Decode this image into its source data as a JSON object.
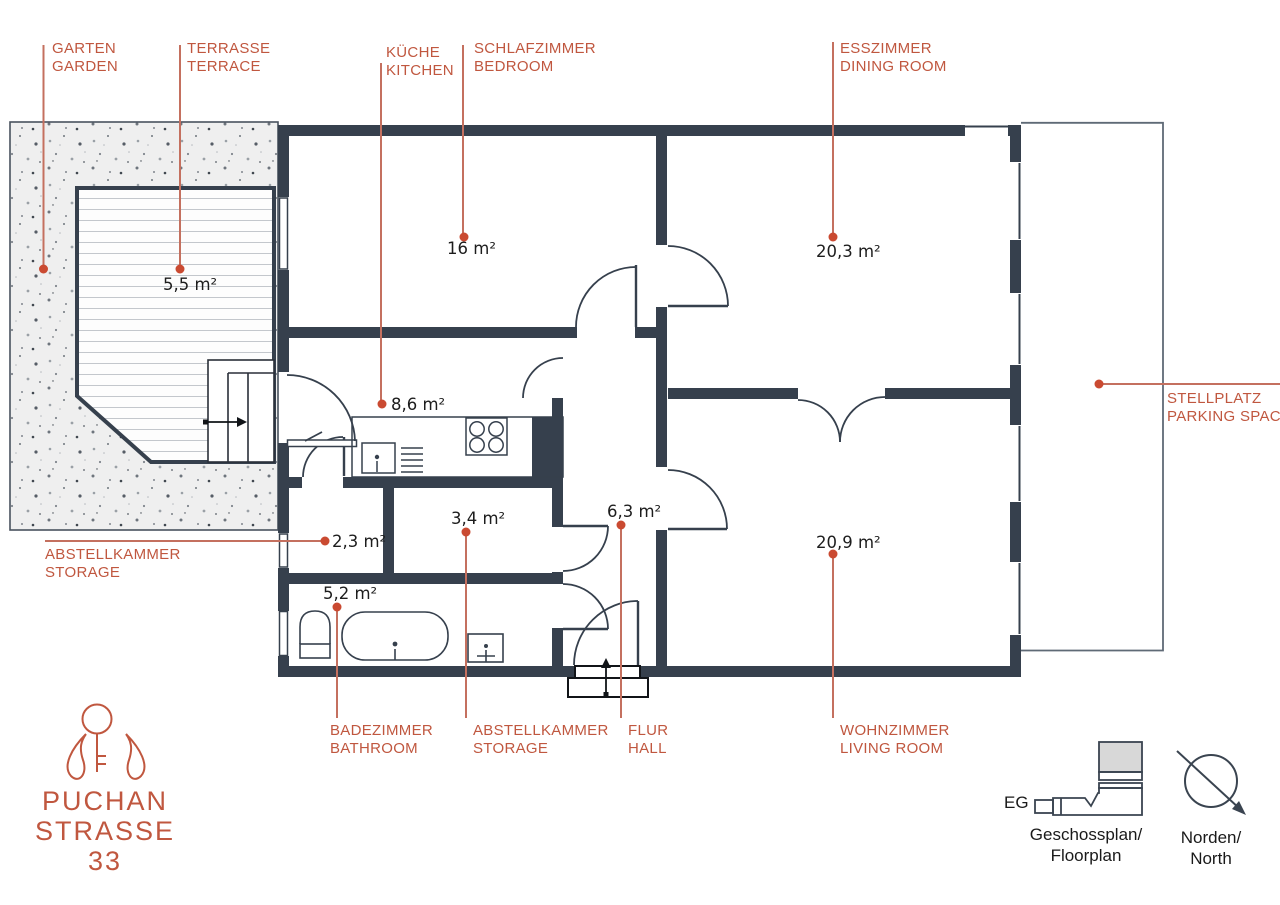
{
  "plan": {
    "callouts": {
      "garten": {
        "de": "GARTEN",
        "en": "GARDEN"
      },
      "terrasse": {
        "de": "TERRASSE",
        "en": "TERRACE"
      },
      "kueche": {
        "de": "KÜCHE",
        "en": "KITCHEN"
      },
      "schlafzimmer": {
        "de": "SCHLAFZIMMER",
        "en": "BEDROOM"
      },
      "esszimmer": {
        "de": "ESSZIMMER",
        "en": "DINING ROOM"
      },
      "stellplatz": {
        "de": "STELLPLATZ",
        "en": "PARKING SPACES"
      },
      "abstell_left": {
        "de": "ABSTELLKAMMER",
        "en": "STORAGE"
      },
      "badezimmer": {
        "de": "BADEZIMMER",
        "en": "BATHROOM"
      },
      "abstell_bottom": {
        "de": "ABSTELLKAMMER",
        "en": "STORAGE"
      },
      "flur": {
        "de": "FLUR",
        "en": "HALL"
      },
      "wohnzimmer": {
        "de": "WOHNZIMMER",
        "en": "LIVING ROOM"
      }
    },
    "areas": {
      "bedroom": "16 m²",
      "dining": "20,3 m²",
      "terrace": "5,5 m²",
      "kitchen": "8,6 m²",
      "storage_small": "2,3 m²",
      "storage_mid": "3,4 m²",
      "hall": "6,3 m²",
      "living": "20,9 m²",
      "bathroom": "5,2 m²"
    }
  },
  "logo": {
    "line1": "PUCHAN",
    "line2": "STRASSE",
    "line3": "33"
  },
  "legend": {
    "eg": "EG",
    "floorplan_de": "Geschossplan/",
    "floorplan_en": "Floorplan",
    "north_de": "Norden/",
    "north_en": "North"
  },
  "colors": {
    "wall": "#36404d",
    "accent_text": "#c0573f",
    "leader_line": "#c4705f",
    "leader_dot": "#ca4a31"
  }
}
